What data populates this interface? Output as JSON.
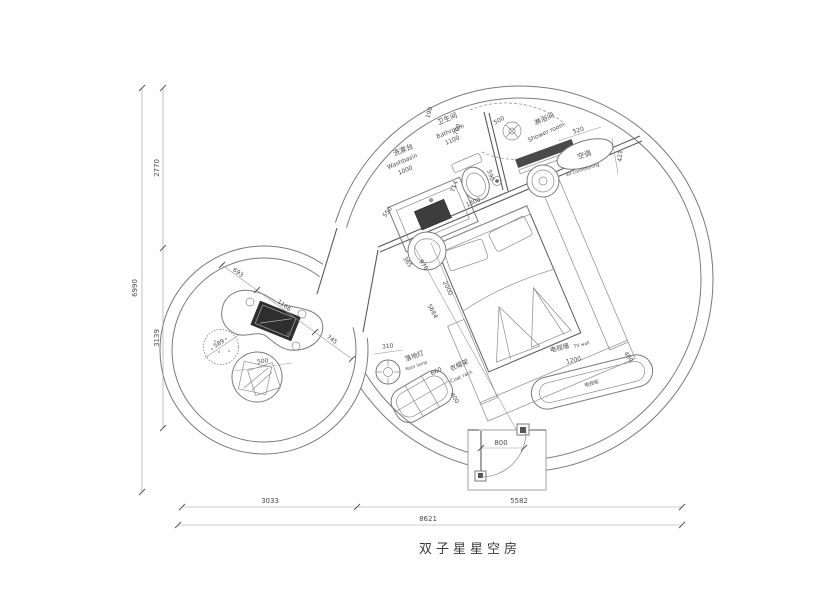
{
  "title": "双子星星空房",
  "ink": "#555555",
  "dims": {
    "total_h": "6990",
    "h_top": "2770",
    "h_bottom": "3139",
    "w_left": "3033",
    "w_right": "5582",
    "total_w": "8621"
  },
  "bath": {
    "washbasin_cn": "洗漱台",
    "washbasin_en": "Washbasin",
    "washbasin_w": "1000",
    "bathroom_cn": "卫生间",
    "bathroom_en": "Bathroom",
    "bathroom_w": "1100",
    "d190": "190",
    "d700": "700",
    "d500": "500",
    "d714": "714",
    "d550": "550",
    "d590": "590",
    "d1800": "1800",
    "shower_cn": "淋浴间",
    "shower_en": "Shower room",
    "d520": "520",
    "ac_cn": "空调",
    "ac_en": "air-conditioning",
    "d421": "421"
  },
  "bed": {
    "d365": "365",
    "d970": "970",
    "d2000": "2000",
    "d5684": "5684"
  },
  "lounge": {
    "d693": "693",
    "d1166": "1166",
    "d745": "745",
    "d589": "589",
    "d500": "500"
  },
  "misc": {
    "lamp_d": "310",
    "lamp_cn": "落地灯",
    "lamp_en": "floor lamp",
    "coat_d": "660",
    "coat_cn": "衣帽架",
    "coat_en": "Coat rack",
    "coat_depth": "400",
    "tv_cn": "电视墙",
    "tv_en": "TV wall",
    "tv_len": "1200",
    "tv_depth": "400",
    "tv_cab": "电视柜",
    "door_w": "800"
  }
}
